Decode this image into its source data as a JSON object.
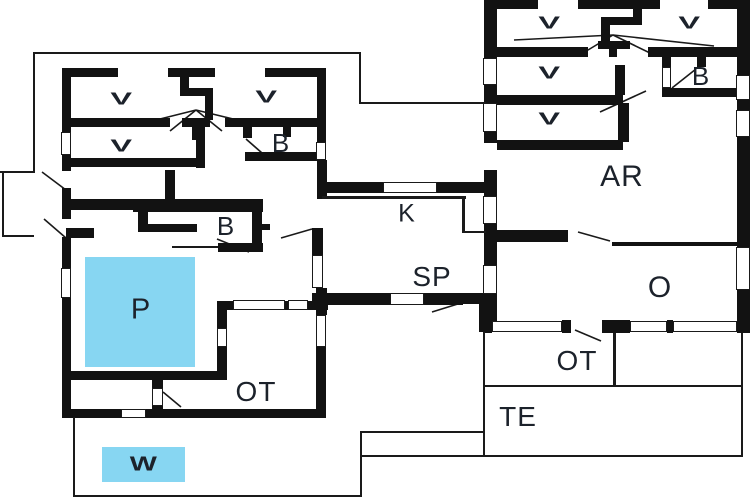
{
  "floorplan": {
    "type": "floor-plan",
    "room_labels": {
      "v": "V",
      "b": "B",
      "k": "K",
      "sp": "SP",
      "ar": "AR",
      "o": "O",
      "ot": "OT",
      "te": "TE",
      "p": "P",
      "w": "W"
    },
    "colors": {
      "background": "#ffffff",
      "wall": "#121212",
      "line": "#1a1a1a",
      "pool_fill": "#87d6f2",
      "label_text": "#1c222b"
    }
  }
}
